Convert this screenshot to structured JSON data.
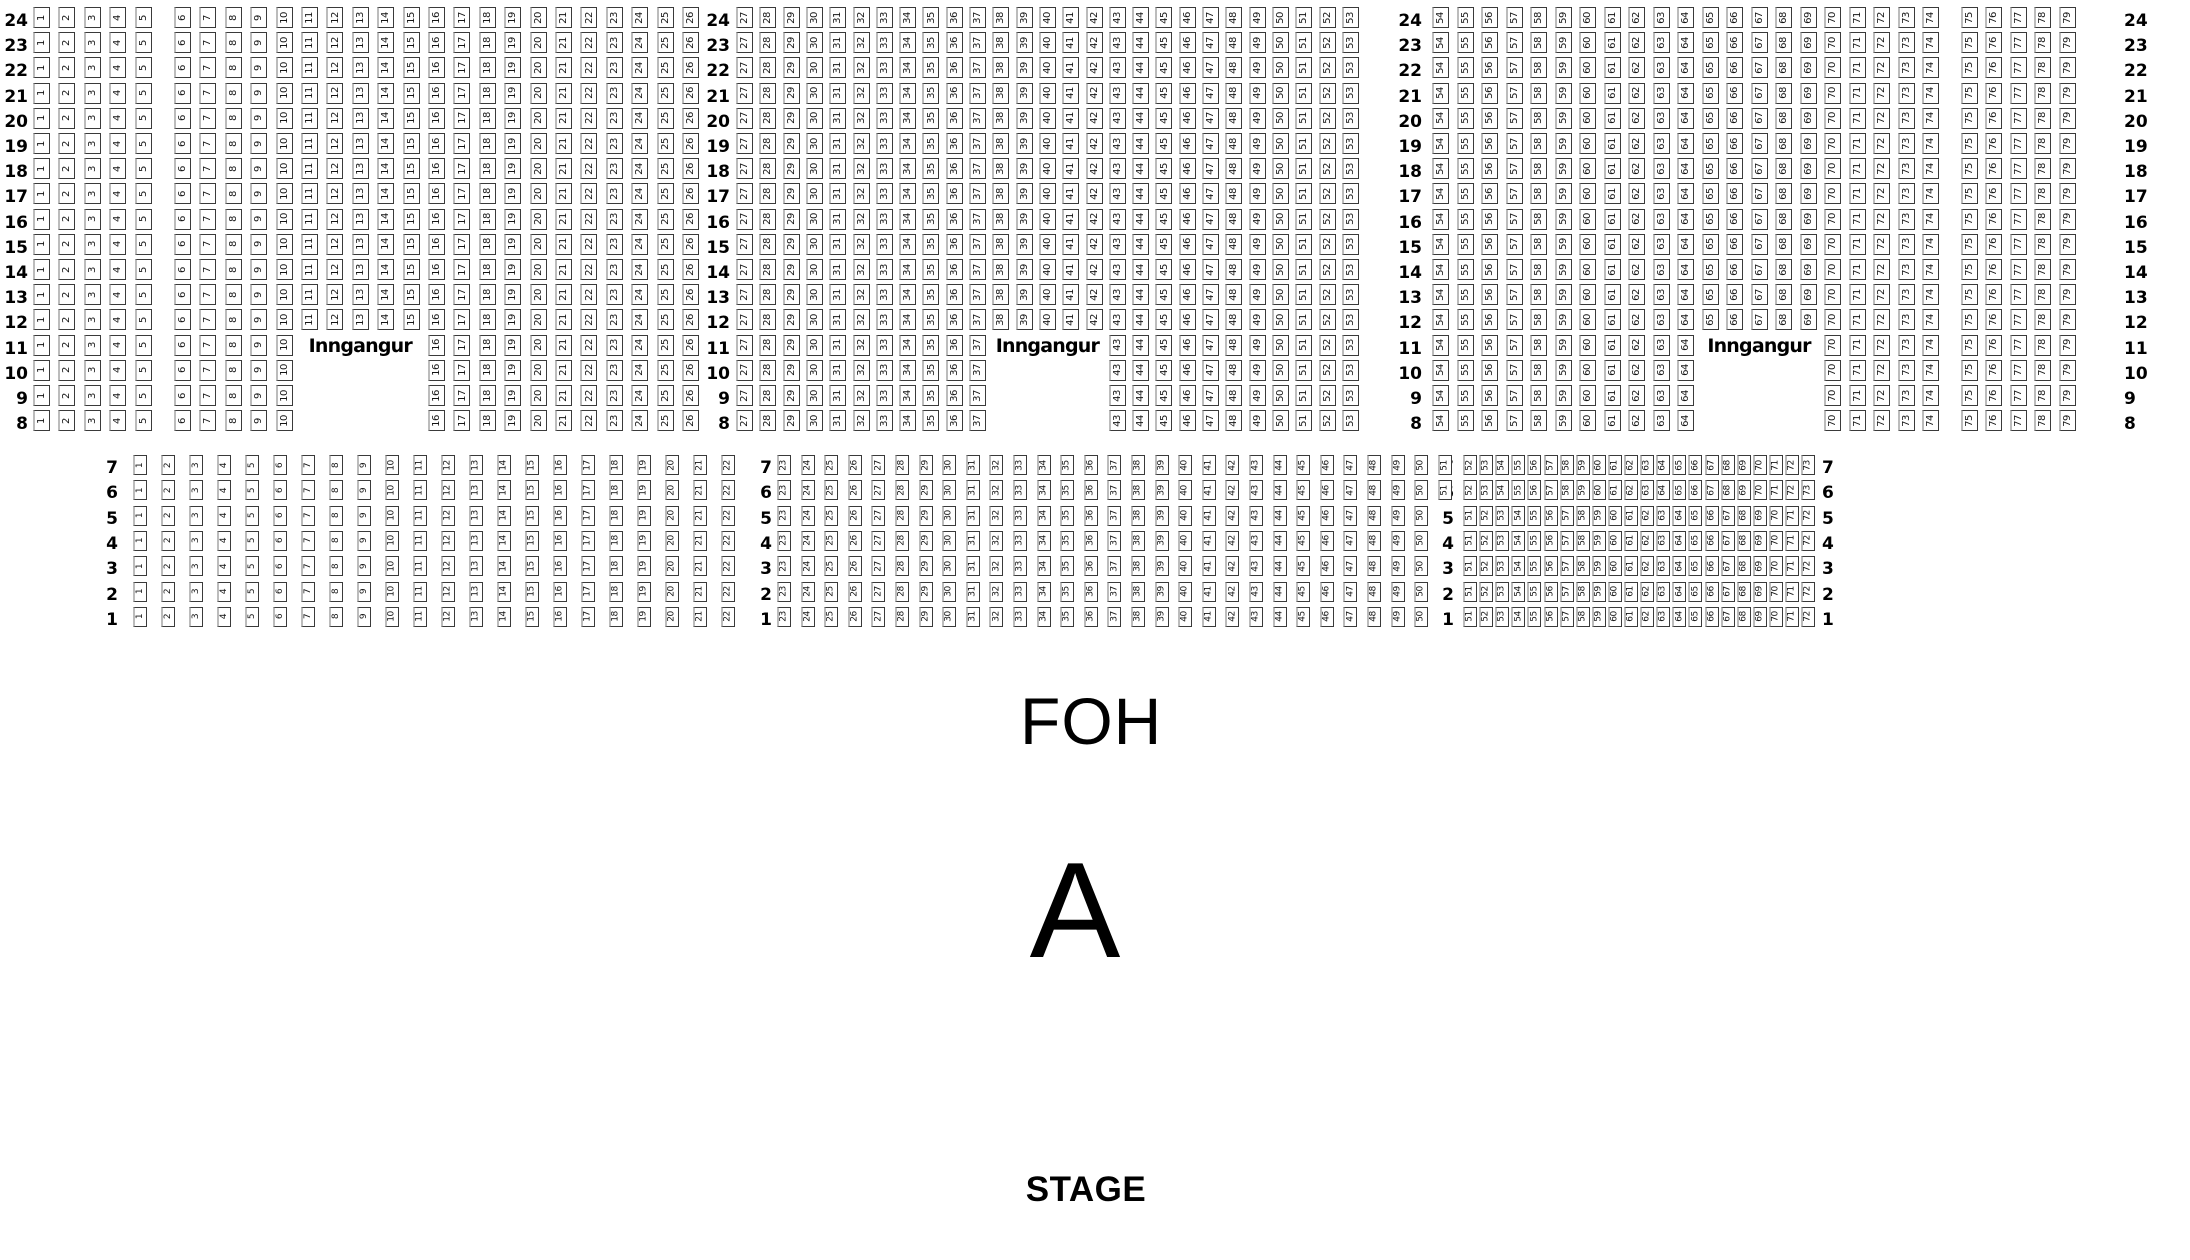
{
  "labels": {
    "foh": "FOH",
    "section_letter": "A",
    "stage": "STAGE",
    "entrance": "Inngangur"
  },
  "colors": {
    "background": "#ffffff",
    "text": "#000000",
    "seat_border": "#3a3a3a",
    "seat_border_light": "#bcbcbc"
  },
  "top_section": {
    "row_labels": [
      "24",
      "23",
      "22",
      "21",
      "20",
      "19",
      "18",
      "17",
      "16",
      "15",
      "14",
      "13",
      "12",
      "11",
      "10",
      "9",
      "8"
    ],
    "entrance_gap_rows": [
      "11",
      "10",
      "9",
      "8"
    ],
    "entrance_text_row": "11",
    "blocks": [
      {
        "id": "top-left",
        "seats_from": 1,
        "seats_to": 26,
        "aisle_after_seat": 5,
        "entrance_covers": [
          11,
          15
        ]
      },
      {
        "id": "top-center",
        "seats_from": 27,
        "seats_to": 53,
        "entrance_covers": [
          38,
          42
        ]
      },
      {
        "id": "top-right",
        "seats_from": 54,
        "seats_to": 79,
        "aisle_after_seat": 74,
        "entrance_covers": [
          65,
          69
        ]
      }
    ]
  },
  "bottom_section": {
    "row_labels": [
      "7",
      "6",
      "5",
      "4",
      "3",
      "2",
      "1"
    ],
    "long_rows": [
      "7",
      "6"
    ],
    "blocks": [
      {
        "id": "bottom-left",
        "numbering": {
          "default": {
            "from": 1,
            "to": 22
          }
        }
      },
      {
        "id": "bottom-center",
        "numbering": {
          "rows_7_6": {
            "from": 23,
            "to": 51
          },
          "rows_5_to_1": {
            "from": 23,
            "to": 50
          }
        }
      },
      {
        "id": "bottom-right",
        "numbering": {
          "rows_7_6": {
            "from": 52,
            "to": 73
          },
          "rows_5_to_1": {
            "from": 51,
            "to": 72
          }
        }
      }
    ]
  }
}
